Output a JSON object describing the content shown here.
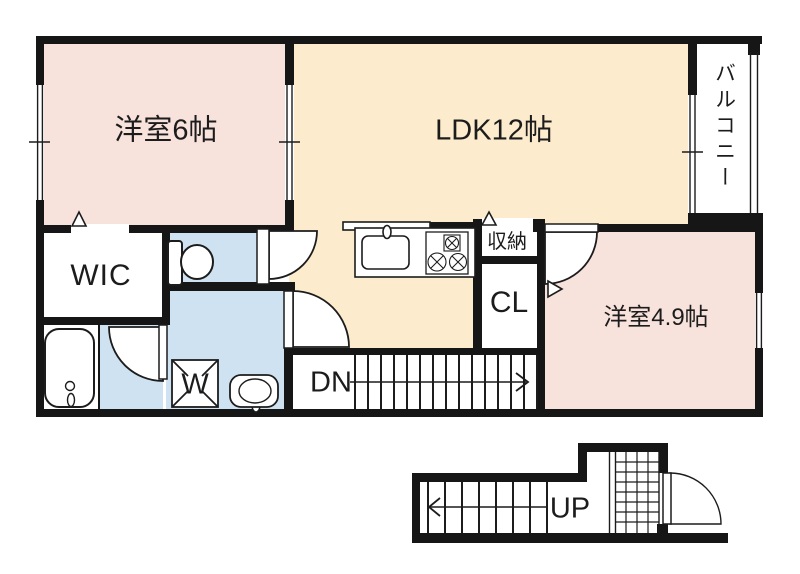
{
  "document": {
    "type": "apartment-floor-plan"
  },
  "colors": {
    "wall": "#161616",
    "line": "#1c1c1c",
    "bedroom_pink": "#f8e2dc",
    "ldk_cream": "#fcebcc",
    "wet_area_blue": "#cfe2f1",
    "white": "#ffffff"
  },
  "rooms": {
    "bedroom6": "洋室6帖",
    "ldk": "LDK12帖",
    "balcony": "バルコニー",
    "wic": "WIC",
    "storage": "収納",
    "closet": "CL",
    "bedroom49": "洋室4.9帖"
  },
  "fixtures": {
    "washer": "W"
  },
  "stairs": {
    "down": "DN",
    "up": "UP"
  }
}
